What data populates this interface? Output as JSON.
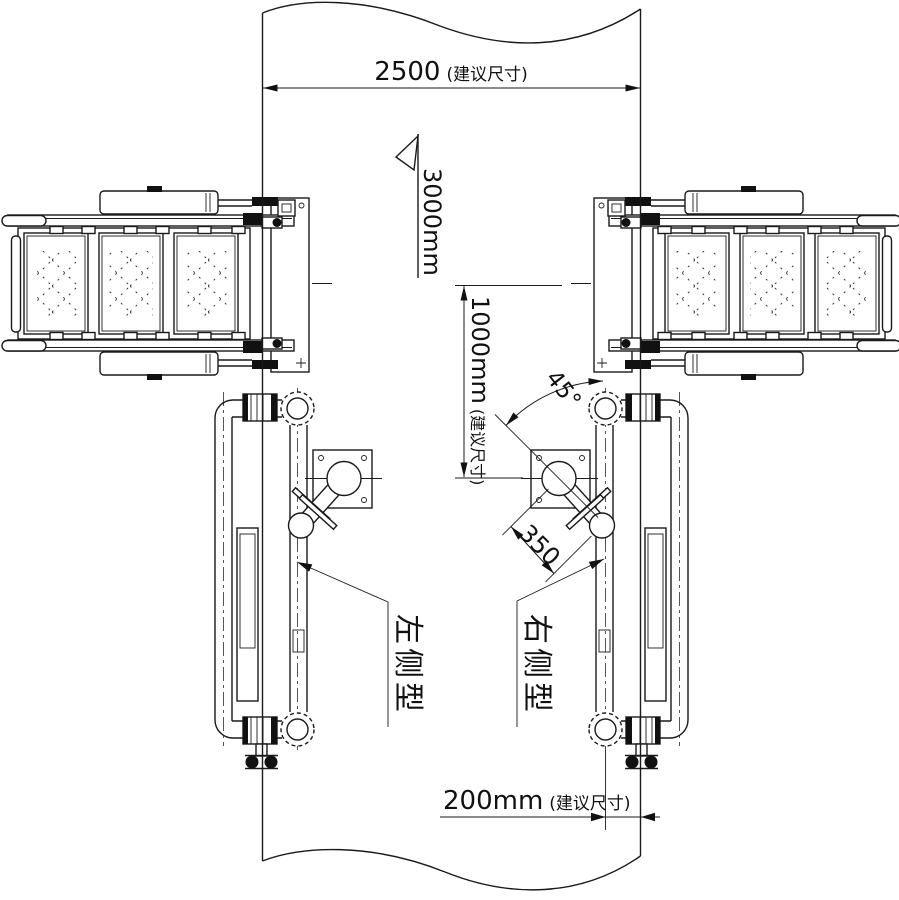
{
  "drawing": {
    "description": "Installation plan drawing of left-type and right-type wall-mounted units",
    "colors": {
      "ink": "#1a1a1a",
      "paper": "#ffffff"
    },
    "dims": {
      "width": {
        "value": "2500",
        "note": "(建议尺寸)"
      },
      "height_flag": {
        "value": "3000mm"
      },
      "offset": {
        "value": "1000mm",
        "note": "(建议尺寸)"
      },
      "angle": {
        "value": "45°"
      },
      "arm": {
        "value": "350"
      },
      "clearance": {
        "value": "200mm",
        "note": "(建议尺寸)"
      }
    },
    "labels": {
      "left_model": "左侧型",
      "right_model": "右侧型"
    }
  }
}
